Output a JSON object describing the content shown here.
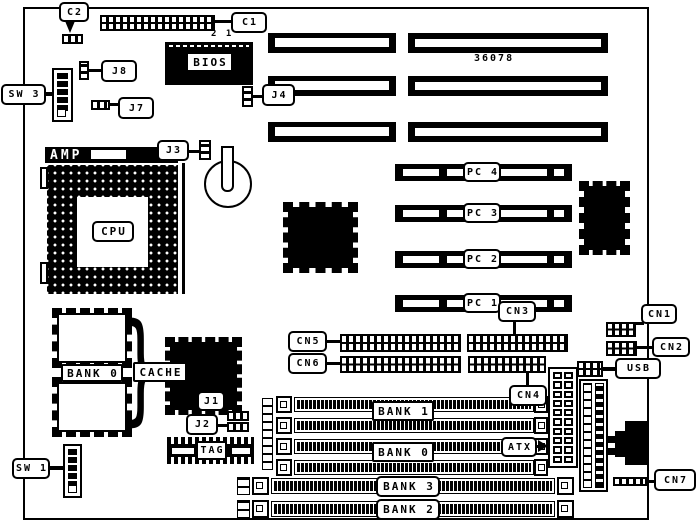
{
  "diagram": {
    "type": "motherboard-layout",
    "colors": {
      "ink": "#000000",
      "paper": "#ffffff"
    },
    "texts": {
      "board_number": "36078",
      "c1_pin_numbers": "2 1",
      "cache_brace": "}"
    },
    "labels": {
      "c1": "C1",
      "c2": "C2",
      "bios": "BIOS",
      "cpu": "CPU",
      "amp": "AMP",
      "cache": "CACHE",
      "bank0_cache": "BANK 0",
      "tag": "TAG",
      "j1": "J1",
      "j2": "J2",
      "j3": "J3",
      "j4": "J4",
      "j7": "J7",
      "j8": "J8",
      "sw1": "SW 1",
      "sw3": "SW 3",
      "pc1": "PC 1",
      "pc2": "PC 2",
      "pc3": "PC 3",
      "pc4": "PC 4",
      "cn1": "CN1",
      "cn2": "CN2",
      "cn3": "CN3",
      "cn4": "CN4",
      "cn5": "CN5",
      "cn6": "CN6",
      "cn7": "CN7",
      "usb": "USB",
      "atx": "ATX",
      "bank0": "BANK 0",
      "bank1": "BANK 1",
      "bank2": "BANK 2",
      "bank3": "BANK 3"
    }
  }
}
